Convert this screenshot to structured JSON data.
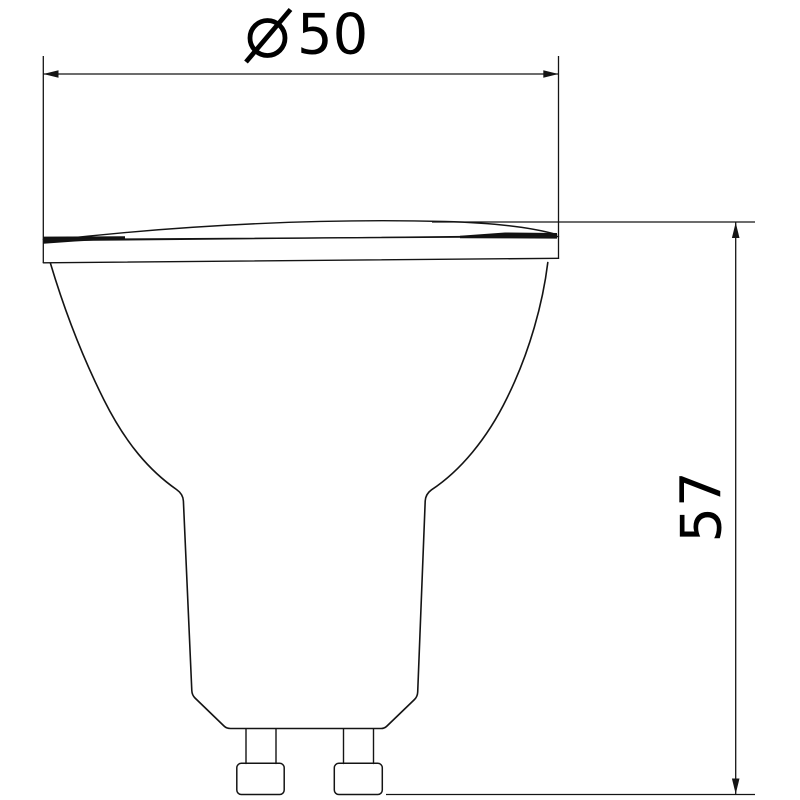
{
  "diagram": {
    "type": "technical-drawing",
    "description": "Side-profile line drawing of a GU10 LED spot lamp with two overall dimensions",
    "background": "#ffffff",
    "line_color": "#141414",
    "dimensions": [
      {
        "id": "diameter",
        "symbol": "⌀",
        "number": "50",
        "label": "⌀50",
        "orientation": "horizontal"
      },
      {
        "id": "height",
        "symbol": "",
        "number": "57",
        "label": "57",
        "orientation": "vertical"
      }
    ]
  }
}
